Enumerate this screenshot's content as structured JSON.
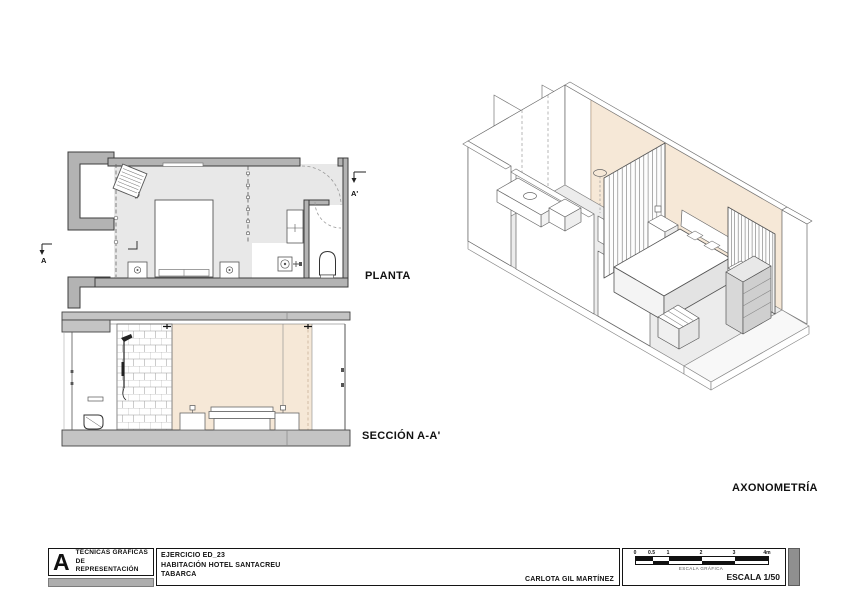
{
  "sheet": {
    "labels": {
      "planta": "PLANTA",
      "seccion": "SECCIÓN A-A'",
      "axonometria": "AXONOMETRÍA"
    },
    "section_marks": {
      "start": "A",
      "end": "A'"
    }
  },
  "titleblock": {
    "logo_letter": "A",
    "course_line1": "TÉCNICAS GRÁFICAS",
    "course_line2": "DE REPRESENTACIÓN",
    "exercise": "EJERCICIO ED_23",
    "project": "HABITACIÓN HOTEL SANTACREU",
    "location": "TABARCA",
    "author": "CARLOTA GIL MARTÍNEZ",
    "scale_label": "ESCALA 1/50",
    "scale_caption": "ESCALA GRÁFICA",
    "scale_ticks": [
      "0",
      "0.5",
      "1",
      "2",
      "3",
      "4m"
    ]
  },
  "colors": {
    "wall_gray": "#b3b3b3",
    "slab_gray": "#c4c4c4",
    "floor_gray": "#e8e8e8",
    "accent_peach": "#f6e8d7",
    "line": "#444444"
  }
}
